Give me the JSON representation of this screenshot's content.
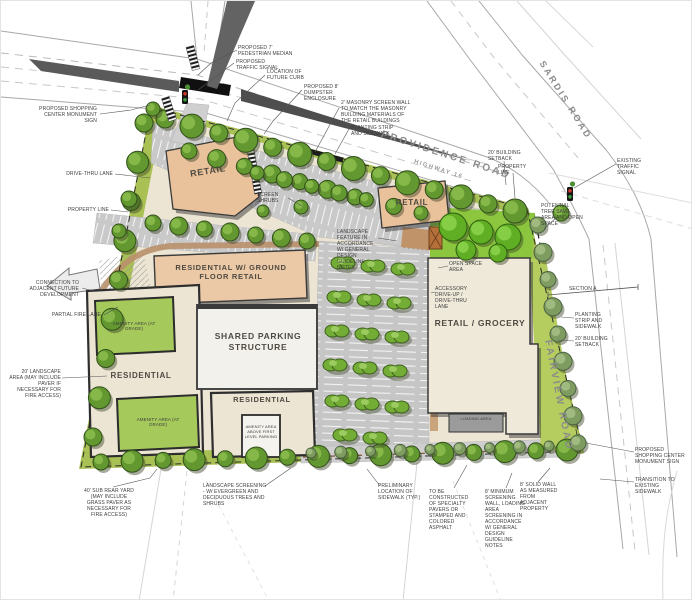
{
  "plan": {
    "palette": {
      "site_green": "#a9c154",
      "tree_green": "#62982f",
      "bright_green": "#5fae24",
      "parking_gray": "#c9c9c9",
      "building_peach": "#e9c29c",
      "building_cream": "#ece5d3",
      "walkway_tan": "#b9906a",
      "signal_red": "#cc3a2e",
      "signal_green": "#3f9b3f"
    },
    "roads": {
      "providence": "PROVIDENCE ROAD",
      "providence_sub": "HIGHWAY 16",
      "sardis": "SARDIS ROAD",
      "fairview": "FAIRVIEW ROAD"
    },
    "buildings": {
      "retail_nw": "RETAIL",
      "retail_n": "RETAIL",
      "res_gfr": "RESIDENTIAL w/ GROUND FLOOR RETAIL",
      "parking_structure": "SHARED PARKING STRUCTURE",
      "residential_w": "RESIDENTIAL",
      "residential_s": "RESIDENTIAL",
      "grocery": "RETAIL / GROCERY",
      "loading": "LOADING AREA",
      "amenity_nw": "AMENITY AREA (AT GRADE)",
      "amenity_sw": "AMENITY AREA (AT GRADE)",
      "amenity_above": "AMENITY AREA ABOVE FIRST LEVEL PARKING"
    },
    "annotations": {
      "pedestrian_median": "PROPOSED 7' PEDESTRIAN MEDIAN",
      "traffic_signal": "PROPOSED TRAFFIC SIGNAL",
      "future_curb": "LOCATION OF FUTURE CURB",
      "dumpster": "PROPOSED 8' DUMPSTER ENCLOSURE",
      "masonry_wall": "2' MASONRY SCREEN WALL TO MATCH THE MASONRY BUILDING MATERIALS OF THE RETAIL BUILDINGS",
      "planting_strip_n": "PLANTING STRIP AND SIDEWALK",
      "monument_w": "PROPOSED SHOPPING CENTER MONUMENT SIGN",
      "drive_thru": "DRIVE-THRU LANE",
      "property_line_w": "PROPERTY LINE",
      "connection": "CONNECTION TO ADJACENT FUTURE DEVELOPMENT",
      "partial_fire": "PARTIAL FIRE LANE",
      "landscape_20": "20' LANDSCAPE AREA (MAY INCLUDE PAVER IF NECESSARY FOR FIRE ACCESS)",
      "rear_yard_40": "40' SUB REAR YARD (MAY INCLUDE GRASS PAVER AS NECESSARY FOR FIRE ACCESS)",
      "landscape_screening": "LANDSCAPE SCREENING - W/ EVERGREEN AND DECIDUOUS TREES AND SHRUBS",
      "prelim_sidewalk": "PRELIMINARY LOCATION OF SIDEWALK (TYP.)",
      "pavers": "TO BE CONSTRUCTED OF SPECIALTY PAVERS OR STAMPED AND COLORED ASPHALT",
      "screen_wall_8": "8' MINIMUM SCREENING WALL, LOADING AREA SCREENING IN ACCORDANCE W/ GENERAL DESIGN GUIDELINE NOTES",
      "solid_wall_8": "8' SOLID WALL AS MEASURED FROM ADJACENT PROPERTY",
      "monument_se": "PROPOSED SHOPPING CENTER MONUMENT SIGN",
      "transition": "TRANSITION TO EXISTING SIDEWALK",
      "existing_signal": "EXISTING TRAFFIC SIGNAL",
      "tree_save": "POTENTIAL TREE SAVE AREA AND OPEN SPACE",
      "setback_ne": "20' BUILDING SETBACK",
      "property_line_ne": "PROPERTY LINE",
      "section_a": "SECTION A",
      "planting_strip_e": "PLANTING STRIP AND SIDEWALK",
      "setback_e": "20' BUILDING SETBACK",
      "screen_shrubs": "SCREEN SHRUBS",
      "landscape_feature": "LANDSCAPE FEATURE IN ACCORDANCE W/ GENERAL DESIGN GUIDELINE NOTES",
      "open_space": "OPEN SPACE AREA",
      "accessory_drive": "ACCESSORY DRIVE-UP / DRIVE-THRU LANE"
    }
  }
}
